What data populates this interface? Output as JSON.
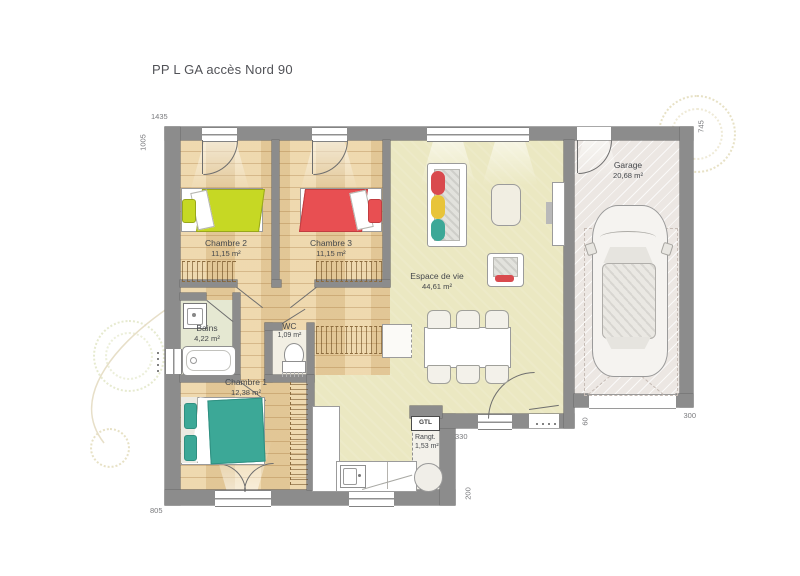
{
  "title": "PP L GA accès Nord 90",
  "rooms": {
    "chambre2": {
      "name": "Chambre 2",
      "area": "11,15 m²"
    },
    "chambre3": {
      "name": "Chambre 3",
      "area": "11,15 m²"
    },
    "espace_de_vie": {
      "name": "Espace de vie",
      "area": "44,61 m²"
    },
    "garage": {
      "name": "Garage",
      "area": "20,68 m²"
    },
    "bains": {
      "name": "Bains",
      "area": "4,22 m²"
    },
    "wc": {
      "name": "WC",
      "area": "1,09 m²"
    },
    "chambre1": {
      "name": "Chambre 1",
      "area": "12,38 m²"
    },
    "rangt": {
      "name": "Rangt.",
      "area": "1,53 m²"
    }
  },
  "annotations": {
    "gtl": "GTL"
  },
  "dimensions": {
    "top_width": "1435",
    "left_height": "1005",
    "garage_right_height": "745",
    "bottom_left_width": "805",
    "entry_width": "330",
    "kitchen_depth": "200",
    "garage_door_width": "300",
    "entry_offset": "60"
  },
  "colors": {
    "wall": "#8c8c8c",
    "wood_floor": "#ecd3a2",
    "living_floor": "#ebe8c2",
    "bains_floor": "#e5e8d2",
    "garage_floor": "#ece7e3",
    "bed_yellow": "#c6d824",
    "bed_red": "#e84f52",
    "bed_teal": "#3ca897"
  }
}
